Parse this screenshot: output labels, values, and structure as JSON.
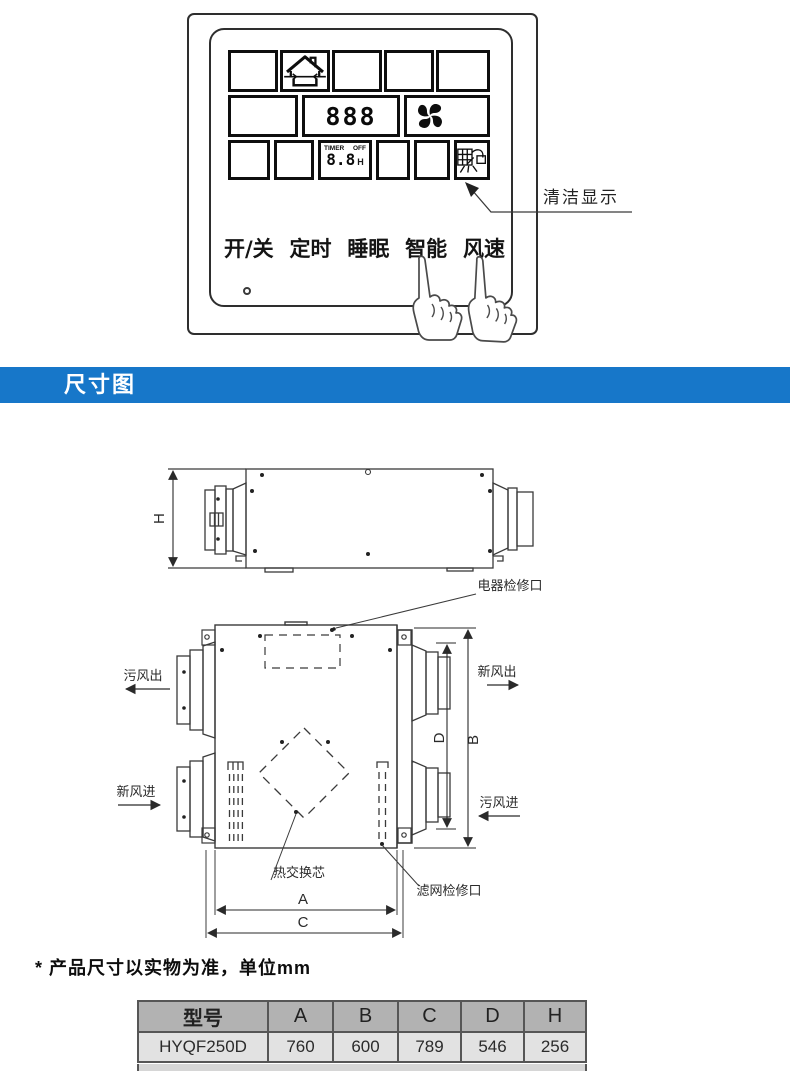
{
  "remote": {
    "display": {
      "digits_main": "888",
      "timer_label": "TIMER",
      "timer_state": "OFF",
      "timer_digits": "8.8",
      "timer_unit": "H"
    },
    "buttons": [
      {
        "label": "开/关"
      },
      {
        "label": "定时"
      },
      {
        "label": "睡眠"
      },
      {
        "label": "智能"
      },
      {
        "label": "风速"
      }
    ],
    "callout": "清洁显示"
  },
  "banner": {
    "title": "尺寸图"
  },
  "diagram": {
    "labels": {
      "dim_h": "H",
      "dim_a": "A",
      "dim_b": "B",
      "dim_c": "C",
      "dim_d": "D",
      "electric_access": "电器检修口",
      "dirty_air_out": "污风出",
      "fresh_air_out": "新风出",
      "fresh_air_in": "新风进",
      "dirty_air_in": "污风进",
      "heat_core": "热交换芯",
      "filter_access": "滤网检修口"
    }
  },
  "note": "* 产品尺寸以实物为准，单位mm",
  "table": {
    "headers": [
      "型号",
      "A",
      "B",
      "C",
      "D",
      "H"
    ],
    "rows": [
      [
        "HYQF250D",
        "760",
        "600",
        "789",
        "546",
        "256"
      ]
    ]
  },
  "colors": {
    "banner_blue": "#1777c9",
    "table_header_gray": "#b2b2b2",
    "table_row_gray": "#e2e2e2"
  }
}
